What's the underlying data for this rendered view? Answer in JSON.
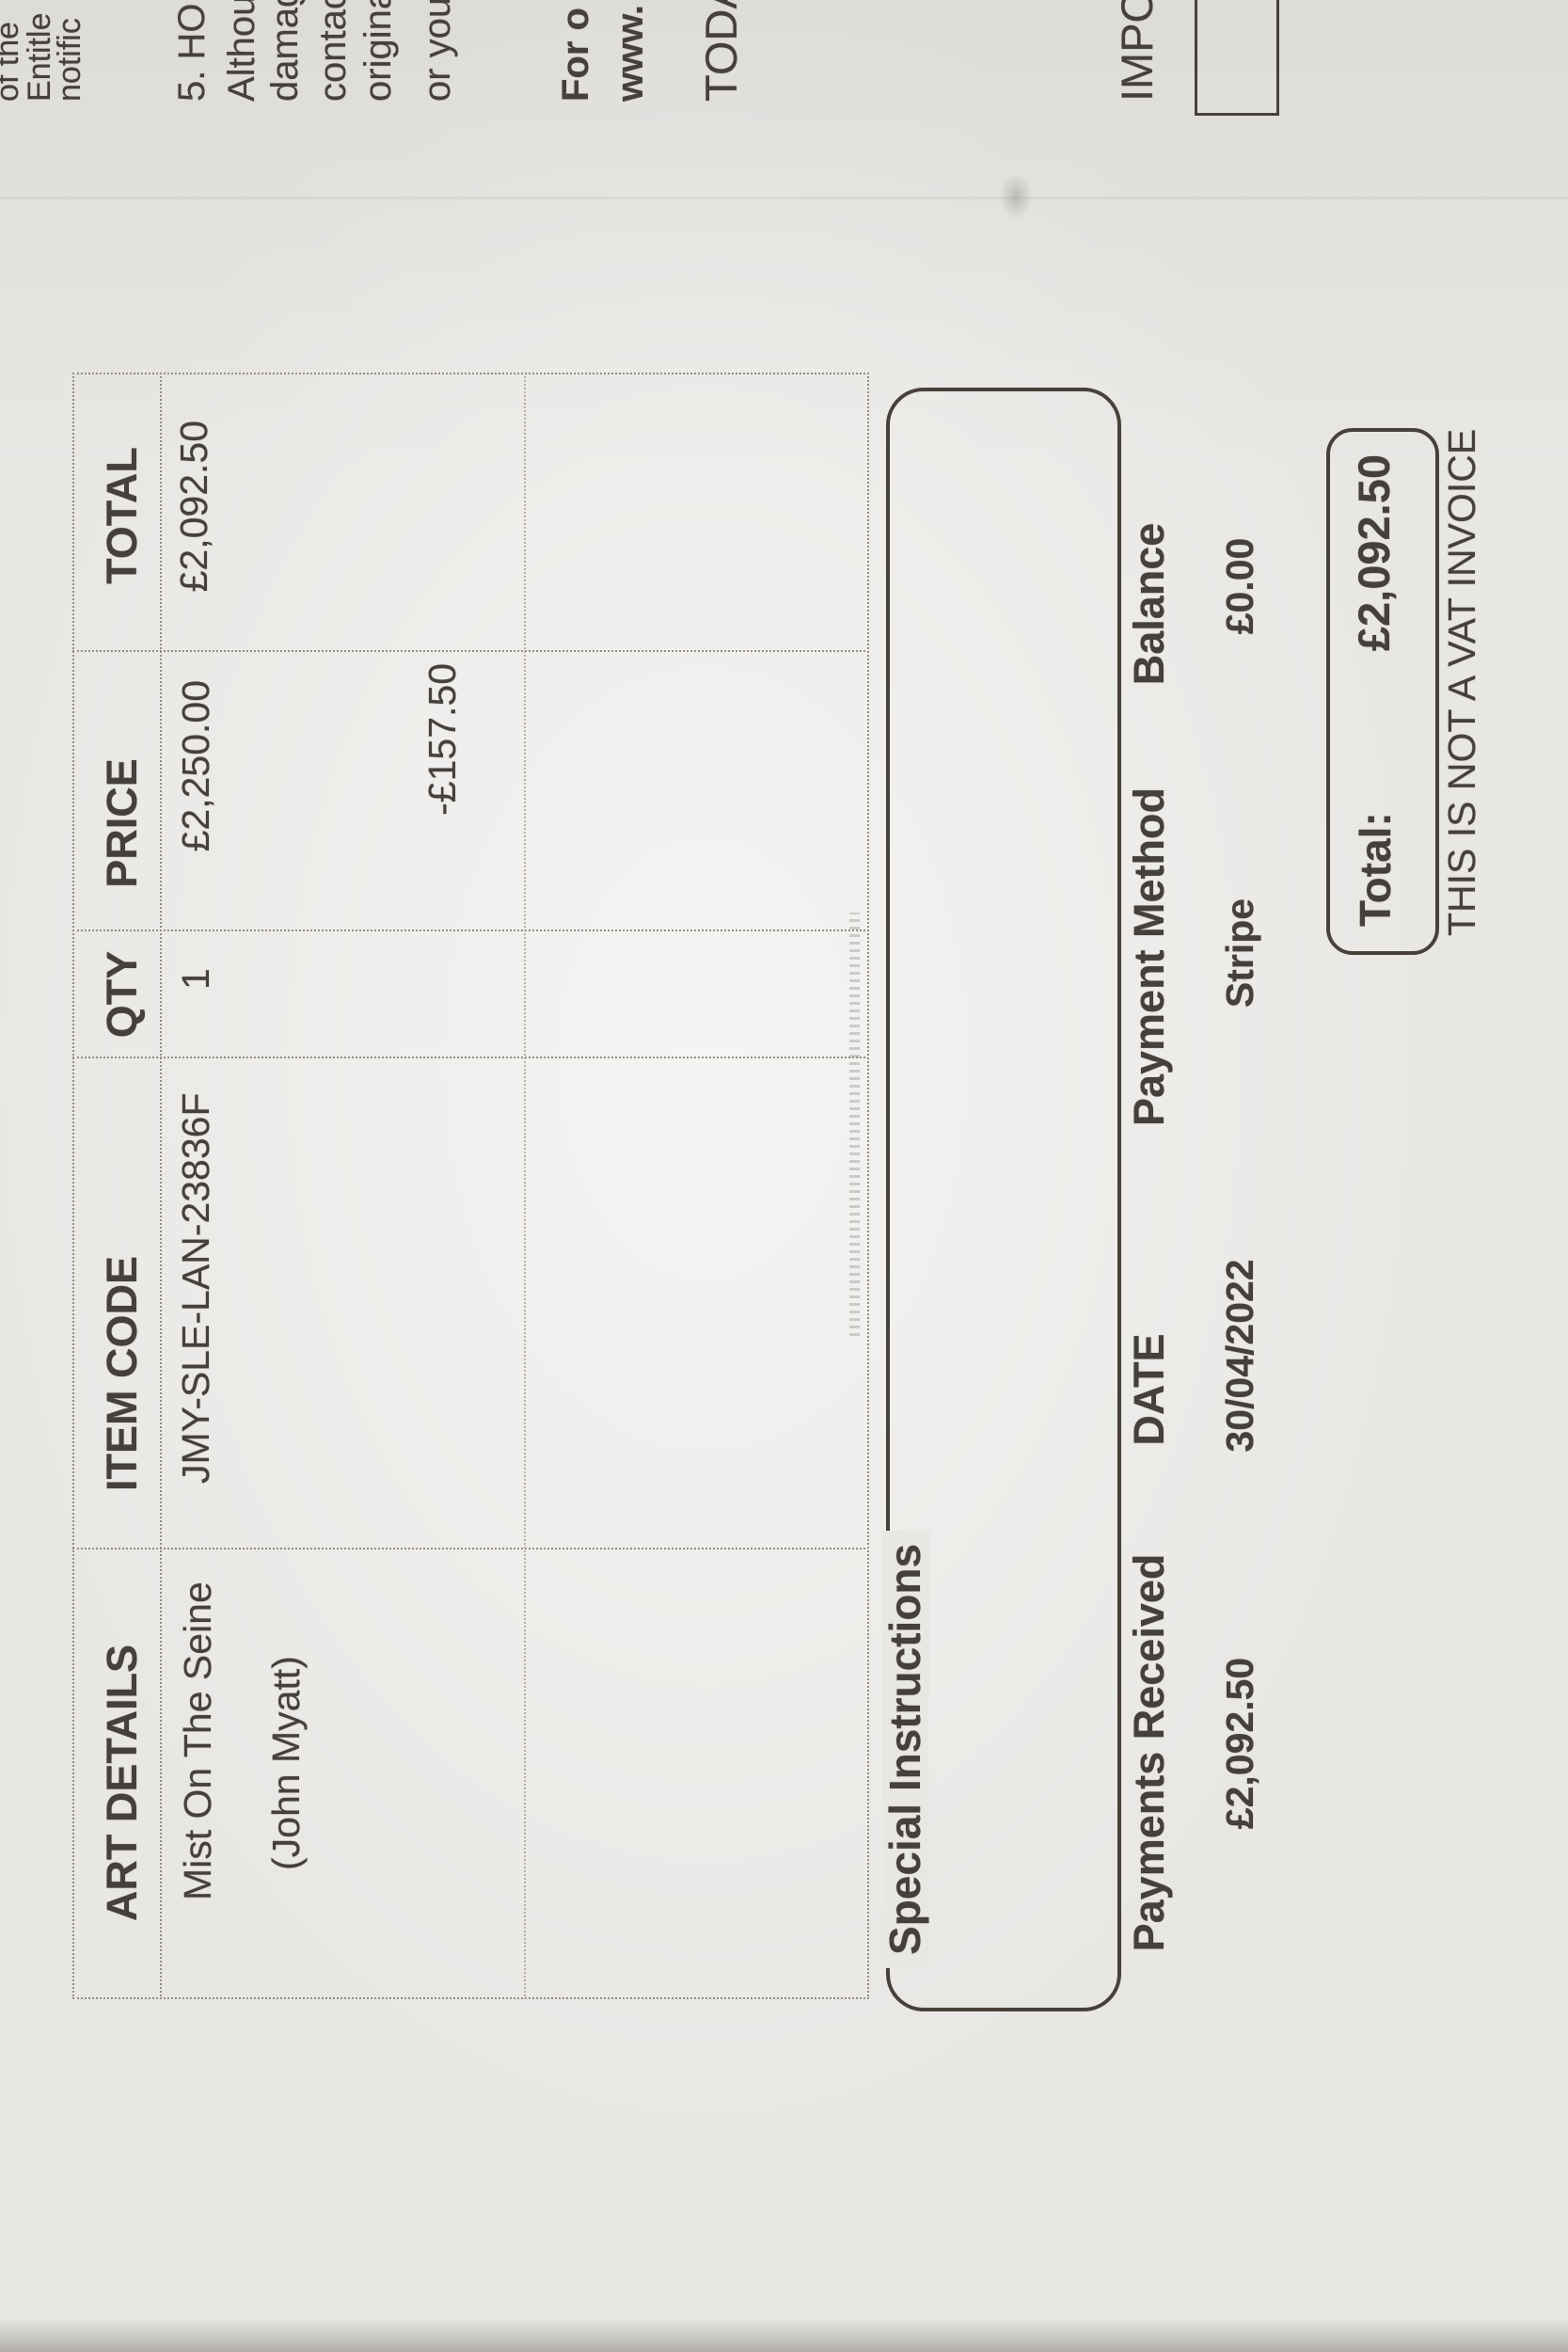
{
  "artwork_table": {
    "headers": [
      "ART DETAILS",
      "ITEM CODE",
      "QTY",
      "PRICE",
      "TOTAL"
    ],
    "row": {
      "art_title": "Mist On The Seine",
      "art_artist": "(John Myatt)",
      "item_code": "JMY-SLE-LAN-23836F",
      "qty": "1",
      "price": "£2,250.00",
      "discount": "-£157.50",
      "total": "£2,092.50"
    }
  },
  "special_instructions_label": "Special Instructions",
  "payment_table": {
    "headers": [
      "Payments Received",
      "DATE",
      "Payment Method",
      "Balance"
    ],
    "values": [
      "£2,092.50",
      "30/04/2022",
      "Stripe",
      "£0.00"
    ]
  },
  "totals": {
    "label": "Total:",
    "amount": "£2,092.50",
    "vat_note": "THIS IS NOT A VAT INVOICE"
  },
  "edge_text": {
    "para1": [
      "of the",
      "Entitle",
      "notific"
    ],
    "para2": [
      "5. HO",
      "Althou",
      "damag",
      "contac",
      "origina",
      "or you"
    ],
    "para3": [
      "For o",
      "www."
    ],
    "line_today": "TODA",
    "line_important": "IMPO"
  }
}
